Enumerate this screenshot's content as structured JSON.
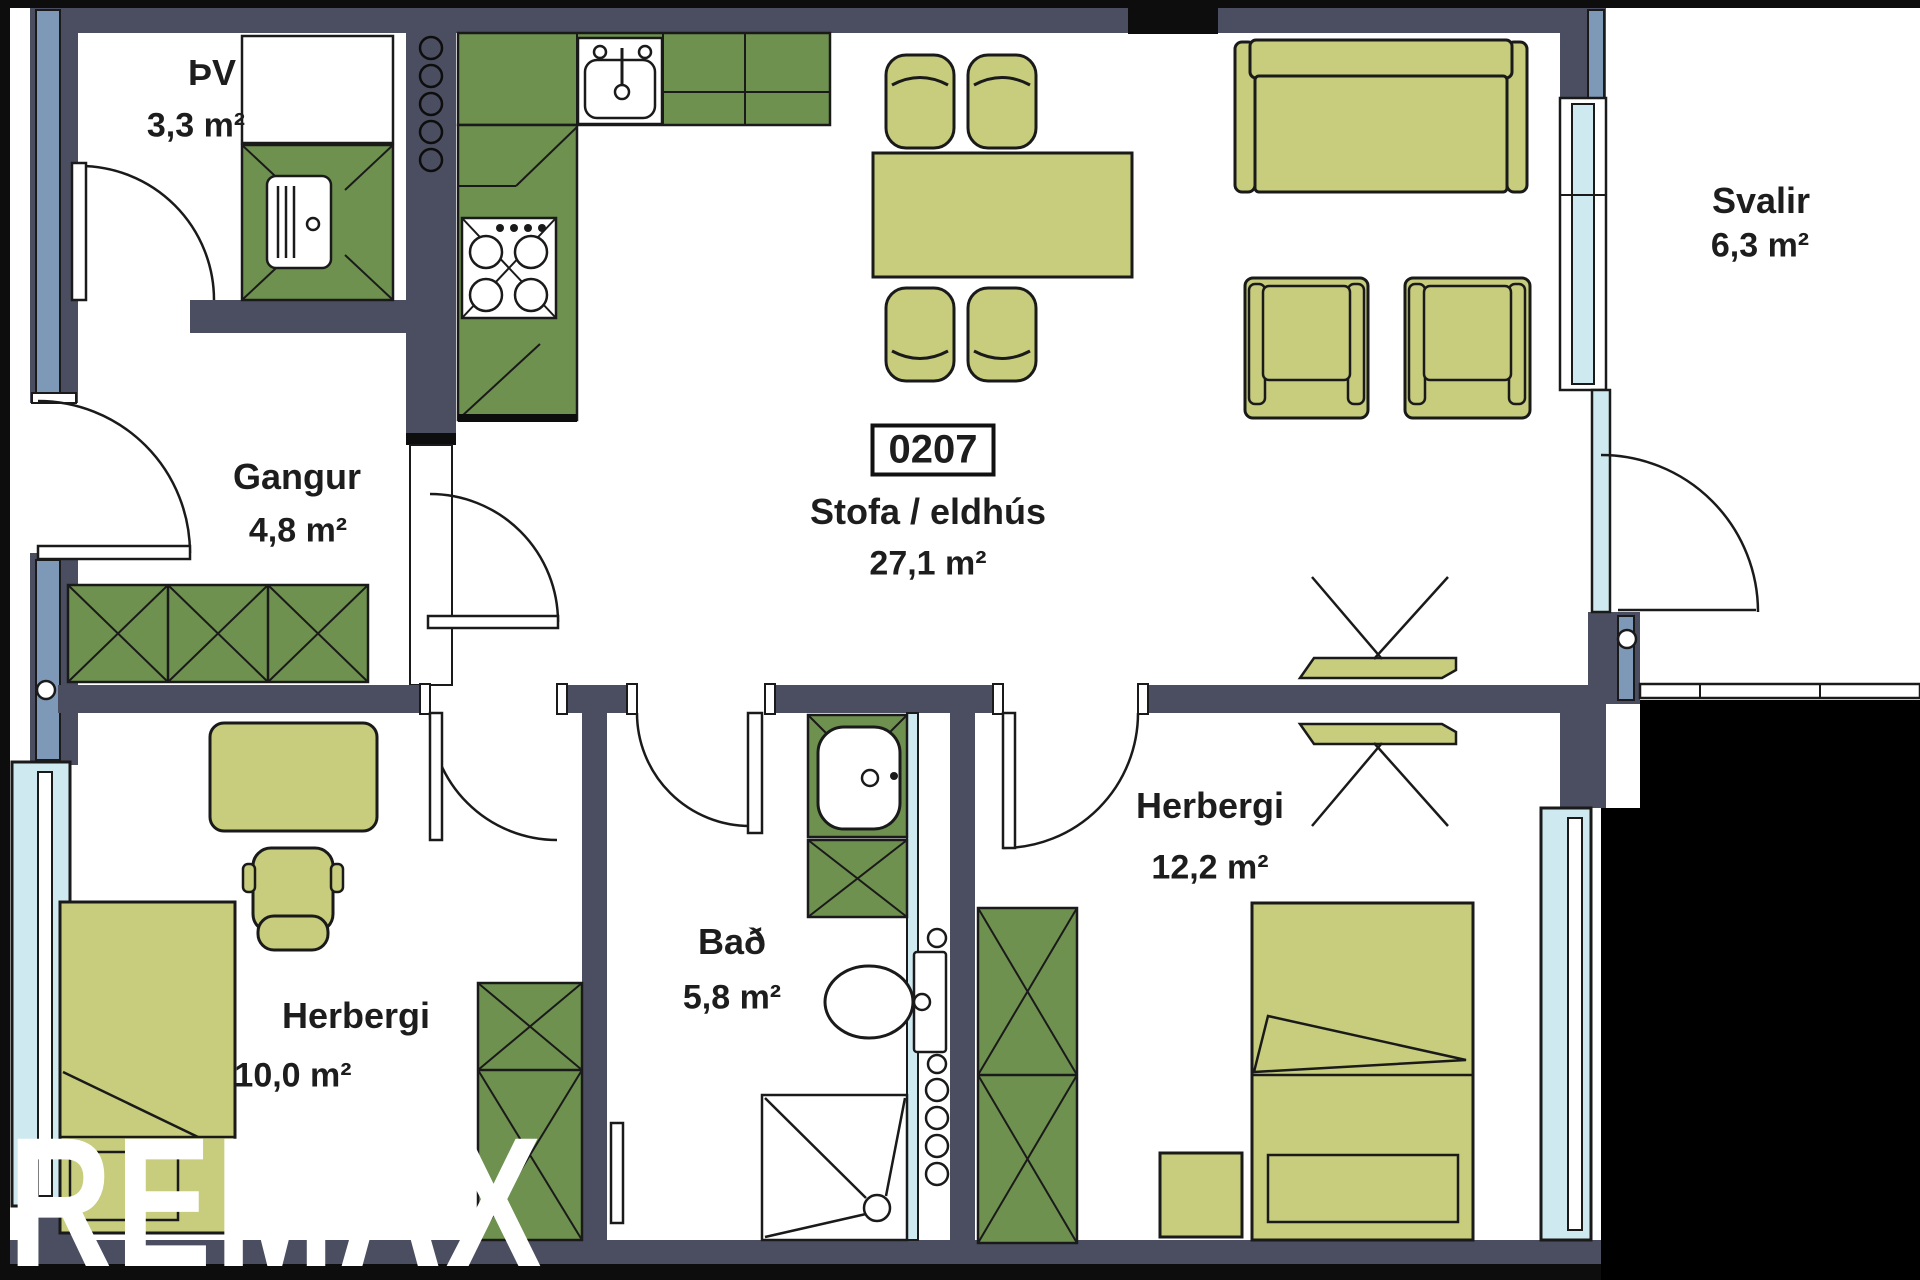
{
  "unit": {
    "number": "0207"
  },
  "rooms": [
    {
      "id": "pv",
      "name": "ÞV",
      "area": "3,3 m²"
    },
    {
      "id": "gangur",
      "name": "Gangur",
      "area": "4,8 m²"
    },
    {
      "id": "stofa",
      "name": "Stofa / eldhús",
      "area": "27,1 m²"
    },
    {
      "id": "svalir",
      "name": "Svalir",
      "area": "6,3 m²"
    },
    {
      "id": "herbergi2",
      "name": "Herbergi",
      "area": "12,2 m²"
    },
    {
      "id": "bad",
      "name": "Bað",
      "area": "5,8 m²"
    },
    {
      "id": "herbergi1",
      "name": "Herbergi",
      "area": "10,0 m²"
    }
  ],
  "watermark": "REMAX",
  "colors": {
    "wall": "#4a4e60",
    "black": "#0d0d0d",
    "cabinet_green": "#6e914f",
    "furniture_green": "#c7cd7c",
    "window_frame_blue": "#7e99b7",
    "glass_blue": "#cfe9f0",
    "outline": "#1a1a1a",
    "background": "#ffffff"
  }
}
